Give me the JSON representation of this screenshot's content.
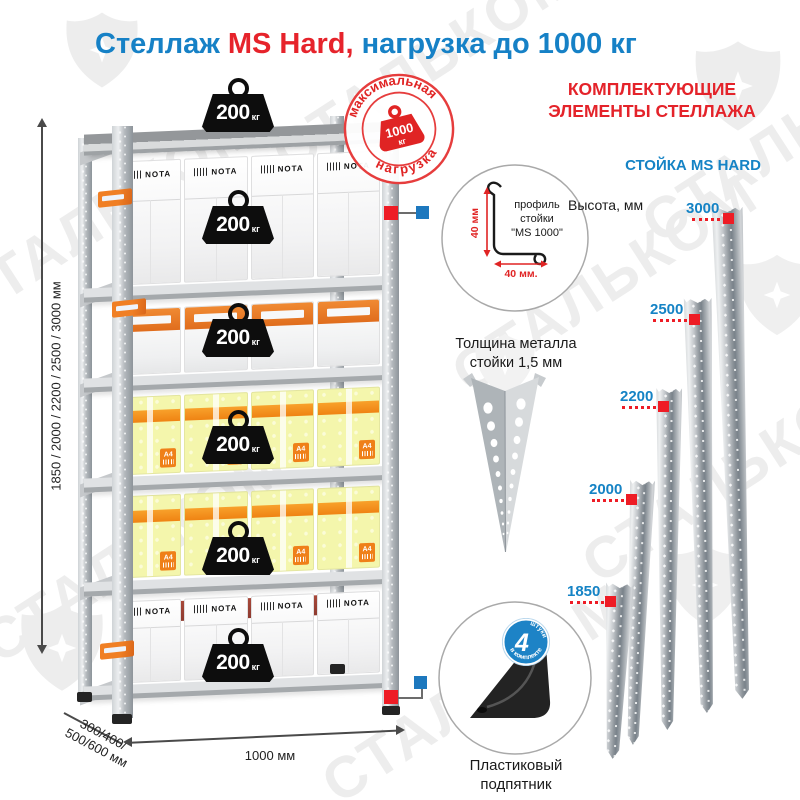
{
  "title": {
    "part1": "Стеллаж ",
    "part2": "MS Hard,",
    "part3": " нагрузка до 1000 кг"
  },
  "stamp": {
    "top_text": "максимальная",
    "bottom_text": "нагрузка",
    "weight_value": "1000",
    "weight_unit": "кг"
  },
  "shelf": {
    "box_brand": "NOTA",
    "box_a4": "A4",
    "weights": [
      {
        "value": "200",
        "unit": "кг"
      },
      {
        "value": "200",
        "unit": "кг"
      },
      {
        "value": "200",
        "unit": "кг"
      },
      {
        "value": "200",
        "unit": "кг"
      },
      {
        "value": "200",
        "unit": "кг"
      },
      {
        "value": "200",
        "unit": "кг"
      }
    ],
    "height_dim": "1850 / 2000 / 2200 / 2500 / 3000 мм",
    "depth_dim_line1": "300/400/",
    "depth_dim_line2": "500/600 мм",
    "width_dim": "1000 мм"
  },
  "profile": {
    "label_line1": "профиль",
    "label_line2": "стойки",
    "label_line3": "\"MS 1000\"",
    "dim_v": "40 мм",
    "dim_h": "40 мм.",
    "caption_line1": "Толщина металла",
    "caption_line2": "стойки 1,5 мм"
  },
  "foot": {
    "badge_number": "4",
    "badge_word1": "штуки",
    "badge_word2": "в комплекте",
    "caption_line1": "Пластиковый",
    "caption_line2": "подпятник"
  },
  "components": {
    "heading_line1": "КОМПЛЕКТУЮЩИЕ",
    "heading_line2": "ЭЛЕМЕНТЫ СТЕЛЛАЖА",
    "subheading": "СТОЙКА MS HARD",
    "height_label": "Высота, мм",
    "posts": [
      {
        "height": "3000"
      },
      {
        "height": "2500"
      },
      {
        "height": "2200"
      },
      {
        "height": "2000"
      },
      {
        "height": "1850"
      }
    ]
  },
  "watermark": {
    "text": "СТАЛЬКОМ"
  },
  "colors": {
    "blue": "#1681c6",
    "red": "#e6232b",
    "badge_blue": "#1d83c6",
    "orange": "#ef8019",
    "yellow": "#f4f6ac"
  }
}
